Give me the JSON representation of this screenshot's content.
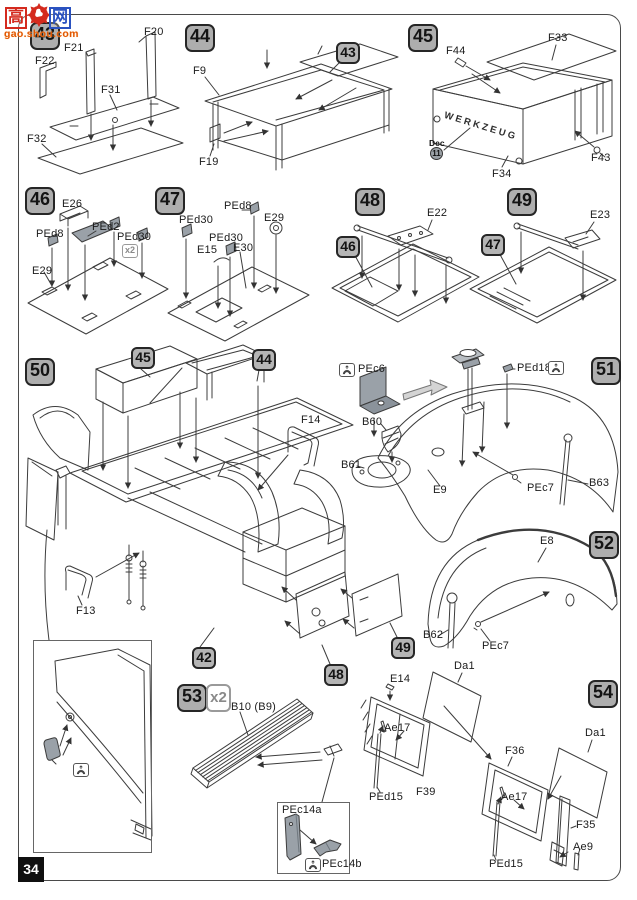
{
  "page": {
    "number": "34"
  },
  "watermark": {
    "char_left": "高",
    "char_right": "网",
    "site": "gao.shou.com"
  },
  "colors": {
    "line": "#3c3c3c",
    "pe_part_fill": "#9aa1a8",
    "badge_bg": "#aeaeae",
    "watermark_red": "#d42a1e",
    "watermark_blue": "#2a52c0",
    "watermark_orange": "#e25500"
  },
  "steps": {
    "s43": {
      "num": "43",
      "f22": "F22",
      "f21": "F21",
      "f20": "F20",
      "f31": "F31",
      "f32": "F32"
    },
    "s44": {
      "num": "44",
      "ref43": "43",
      "f9": "F9",
      "f19": "F19"
    },
    "s45": {
      "num": "45",
      "f44": "F44",
      "f33": "F33",
      "f43": "F43",
      "f34": "F34",
      "dec_label": "Dec",
      "dec_num": "11",
      "box_text": "WERKZEUG"
    },
    "s46": {
      "num": "46",
      "e26": "E26",
      "ped2": "PEd2",
      "ped8": "PEd8",
      "ped30": "PEd30",
      "mult": "x2",
      "e29": "E29"
    },
    "s47": {
      "num": "47",
      "ped30a": "PEd30",
      "ped8": "PEd8",
      "e29": "E29",
      "e15": "E15",
      "ped30b": "PEd30",
      "e30": "E30"
    },
    "s48": {
      "num": "48",
      "ref46": "46",
      "e22": "E22"
    },
    "s49": {
      "num": "49",
      "ref47": "47",
      "e23": "E23"
    },
    "s50": {
      "num": "50",
      "ref45": "45",
      "ref44": "44",
      "ref42": "42",
      "ref48": "48",
      "ref49": "49",
      "f14": "F14",
      "f13": "F13"
    },
    "s51": {
      "num": "51",
      "pec6": "PEc6",
      "b60": "B60",
      "b61": "B61",
      "ped18": "PEd18",
      "e9": "E9",
      "pec7": "PEc7",
      "b63": "B63"
    },
    "s52": {
      "num": "52",
      "e8": "E8",
      "b62": "B62",
      "pec7": "PEc7"
    },
    "door_inset": {
      "ped21": "PEd21"
    },
    "s53": {
      "num": "53",
      "mult": "x2",
      "b10": "B10 (B9)",
      "pec14a": "PEc14a",
      "pec14b": "PEc14b"
    },
    "s54": {
      "num": "54",
      "e14": "E14",
      "da1a": "Da1",
      "ae17a": "Ae17",
      "f39": "F39",
      "ped15a": "PEd15",
      "f36": "F36",
      "ae17b": "Ae17",
      "da1b": "Da1",
      "f35": "F35",
      "ped15b": "PEd15",
      "ae9": "Ae9"
    }
  }
}
